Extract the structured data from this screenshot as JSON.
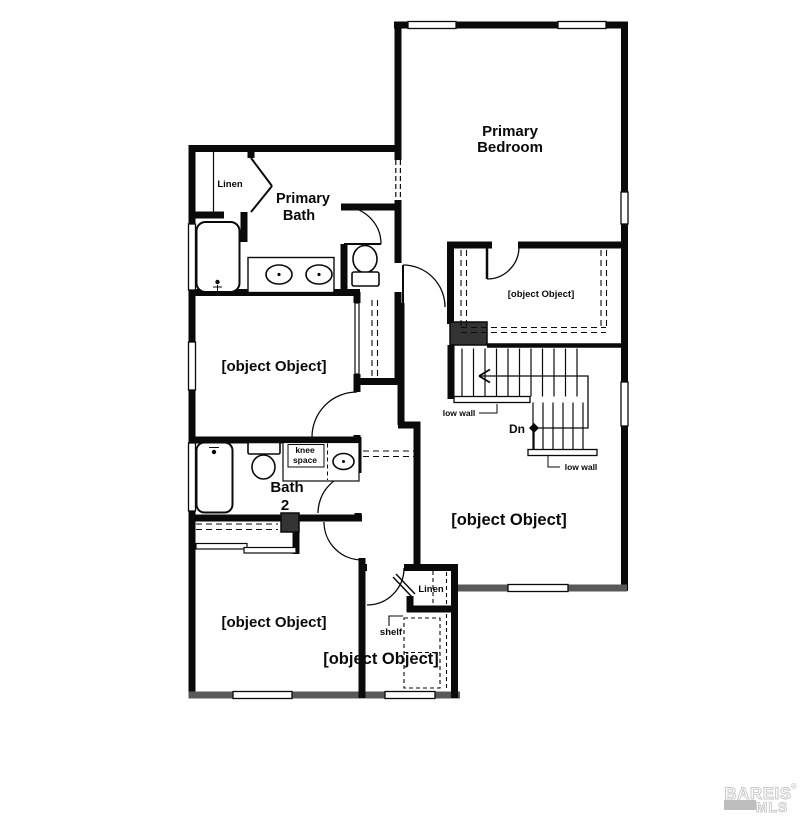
{
  "plan": {
    "type": "floor-plan"
  },
  "rooms": {
    "primary_bedroom": {
      "label": [
        "Primary",
        "Bedroom"
      ]
    },
    "primary_bath": {
      "label": [
        "Primary",
        "Bath"
      ]
    },
    "bedroom2": {
      "label": "Bedroom 2"
    },
    "bedroom3": {
      "label": "Bedroom 3"
    },
    "bath2": {
      "label": [
        "Bath",
        "2"
      ]
    },
    "wic": {
      "label": "W.I.C."
    },
    "loft": {
      "label": "Loft"
    },
    "laundry": {
      "label": "Lau."
    }
  },
  "annotations": {
    "linen_bath": "Linen",
    "linen_laundry": "Linen",
    "knee_space": [
      "knee",
      "space"
    ],
    "low_wall_upper": "low wall",
    "low_wall_lower": "low wall",
    "down": "Dn",
    "shelf": "shelf"
  },
  "watermark": {
    "brand": "BAREIS",
    "registered": "®",
    "org": "MLS"
  },
  "colors": {
    "wall_black": "#0a0a0a",
    "wall_gray": "#58595b",
    "chase_fill": "#333333",
    "watermark_gray": "#c9c9c9",
    "watermark_bar": "#bdbdbd"
  }
}
